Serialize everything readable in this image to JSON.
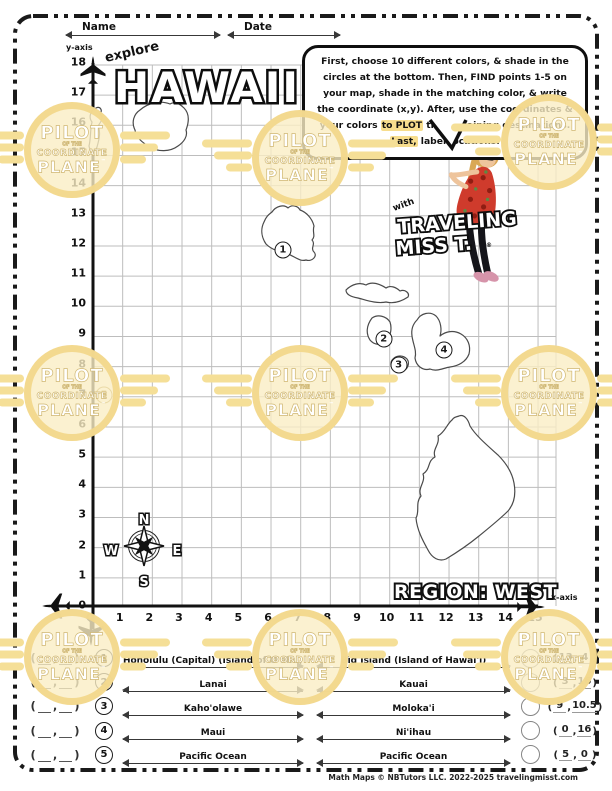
{
  "page": {
    "name_label": "Name",
    "date_label": "Date",
    "footer": "Math Maps © NBTutors LLC. 2022-2025 travelingmisst.com"
  },
  "title": {
    "explore": "explore",
    "main": "HAWAII"
  },
  "speech_bubble": {
    "segments": [
      {
        "text": "First, choose 10 different colors, & shade in the circles at the bottom. Then, FIND points 1-5 on your map, shade in the matching color, & write the coordinate (x,y). After, use the coordinates & your colors ",
        "highlight": false
      },
      {
        "text": "to PLOT",
        "highlight": true
      },
      {
        "text": " the remaining destinations. ",
        "highlight": false
      },
      {
        "text": "Last,",
        "highlight": true
      },
      {
        "text": " label locations.",
        "highlight": false
      }
    ]
  },
  "character": {
    "with": "with",
    "name_line1": "TRAVELING",
    "name_line2": "MISS T.",
    "reg": "®"
  },
  "grid": {
    "x_axis_label": "x-axis",
    "y_axis_label": "y-axis",
    "region_label": "REGION: WEST",
    "x_ticks": [
      "0",
      "1",
      "2",
      "3",
      "4",
      "5",
      "6",
      "7",
      "8",
      "9",
      "10",
      "11",
      "12",
      "13",
      "14",
      "15"
    ],
    "y_ticks": [
      "0",
      "1",
      "2",
      "3",
      "4",
      "5",
      "6",
      "7",
      "8",
      "9",
      "10",
      "11",
      "12",
      "13",
      "14",
      "15",
      "16",
      "17",
      "18"
    ],
    "compass": {
      "n": "N",
      "e": "E",
      "s": "S",
      "w": "W"
    },
    "points": [
      {
        "label": "1",
        "gx": 6.4,
        "gy": 11.85,
        "color": "#1a1a1a"
      },
      {
        "label": "2",
        "gx": 9.8,
        "gy": 8.9,
        "color": "#1a1a1a"
      },
      {
        "label": "3",
        "gx": 10.3,
        "gy": 8.05,
        "color": "#1a1a1a"
      },
      {
        "label": "4",
        "gx": 11.83,
        "gy": 8.55,
        "color": "#1a1a1a"
      },
      {
        "label": "5",
        "gx": 0.37,
        "gy": 7.06,
        "color": "#a8892e"
      }
    ]
  },
  "answers": {
    "left": [
      {
        "num": "1",
        "name": "Honolulu (Capital) (Island of O'ahu)"
      },
      {
        "num": "2",
        "name": "Lanai"
      },
      {
        "num": "3",
        "name": "Kaho'olawe"
      },
      {
        "num": "4",
        "name": "Maui"
      },
      {
        "num": "5",
        "name": "Pacific Ocean"
      }
    ],
    "right": [
      {
        "name": "Big Island (Island of Hawai'i)",
        "x": "13",
        "y": "4"
      },
      {
        "name": "Kauai",
        "x": "3",
        "y": "16"
      },
      {
        "name": "Moloka'i",
        "x": "9",
        "y": "10.5"
      },
      {
        "name": "Ni'ihau",
        "x": "0",
        "y": "16"
      },
      {
        "name": "Pacific Ocean",
        "x": "5",
        "y": "0"
      }
    ]
  },
  "watermark": {
    "w1": "PILOT",
    "w2": "OF THE",
    "w3": "COORDINATE",
    "w4": "PLANE",
    "tm": "™",
    "color": "#F3DC94"
  }
}
